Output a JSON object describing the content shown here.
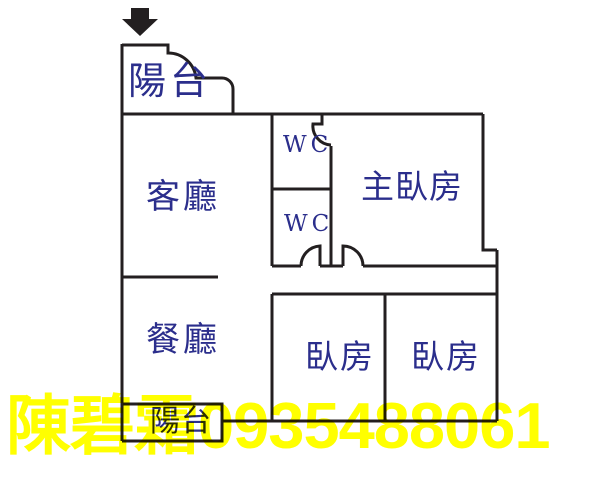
{
  "floorplan": {
    "colors": {
      "wall": "#231f20",
      "room_label": "#2b2e8c",
      "watermark": "#ffff00",
      "background": "#ffffff"
    },
    "entrance": {
      "icon": "down-arrow"
    },
    "rooms": {
      "balcony_top": "陽台",
      "living": "客廳",
      "wc_upper": "WC",
      "wc_lower": "WC",
      "master_bedroom": "主臥房",
      "dining": "餐廳",
      "bedroom_left": "臥房",
      "bedroom_right": "臥房",
      "balcony_bottom": "陽台"
    }
  },
  "watermark": {
    "text": "陳碧霜0935488061"
  }
}
